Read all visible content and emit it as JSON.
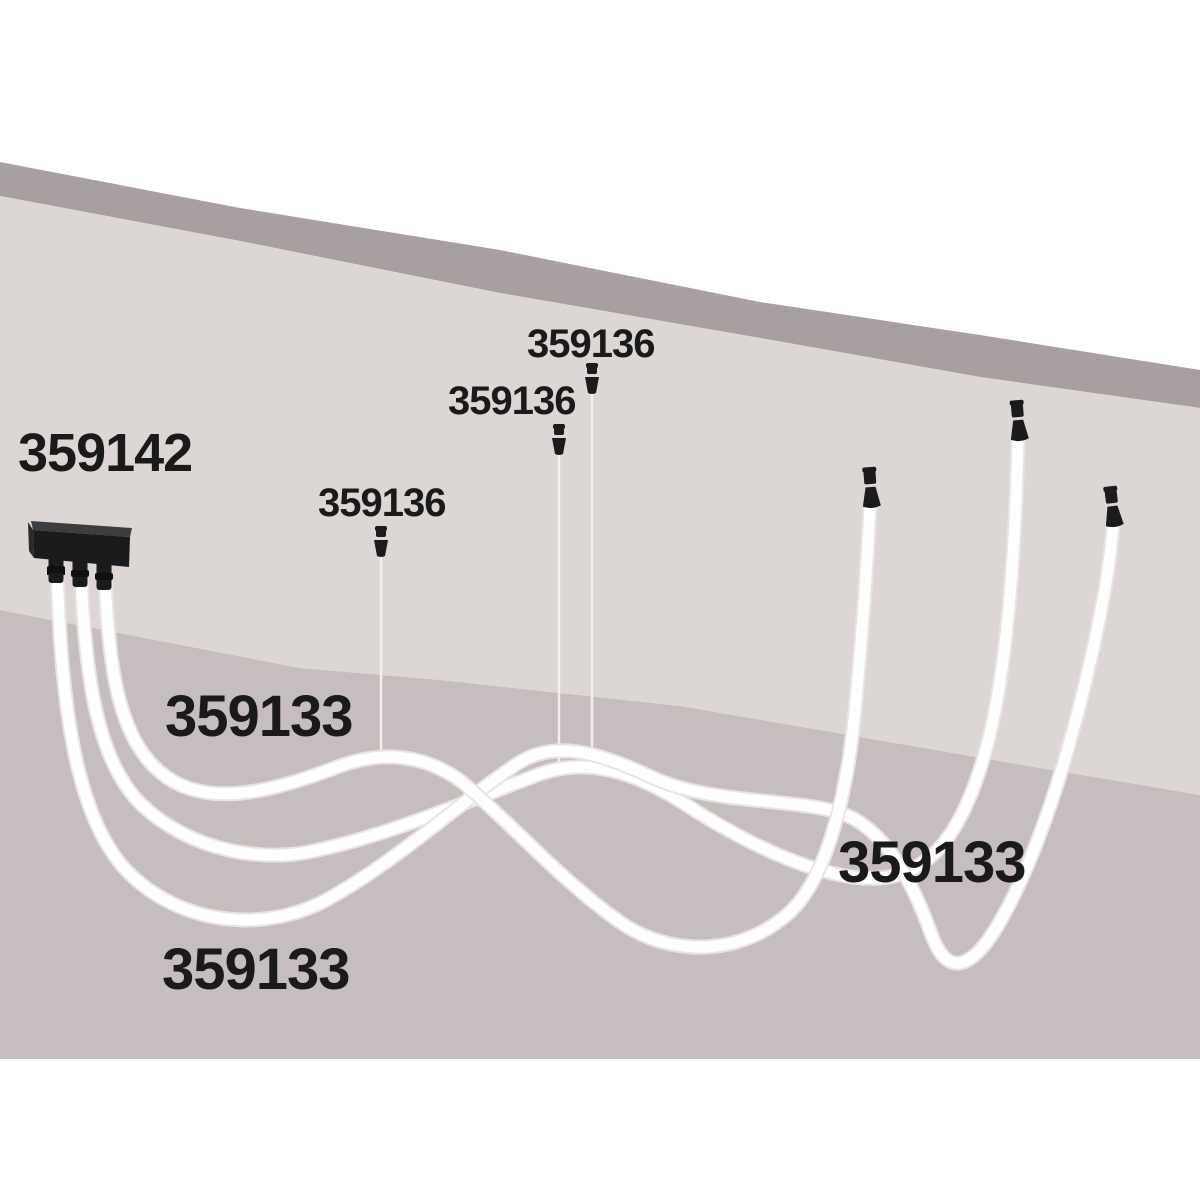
{
  "labels": {
    "driver_box": "359142",
    "suspension_grips": [
      "359136",
      "359136",
      "359136"
    ],
    "flex_tubes": [
      "359133",
      "359133",
      "359133"
    ]
  },
  "colors": {
    "background": "#ffffff",
    "ceiling_edge_band": "#a8a0a0",
    "wall_upper": "#dcd7d5",
    "wall_lower": "#c6bebe",
    "label_text": "#1a1a1a",
    "tube_fill": "#ffffff",
    "tube_edge": "#e9e4e1",
    "hardware_black": "#1b1b1e"
  }
}
